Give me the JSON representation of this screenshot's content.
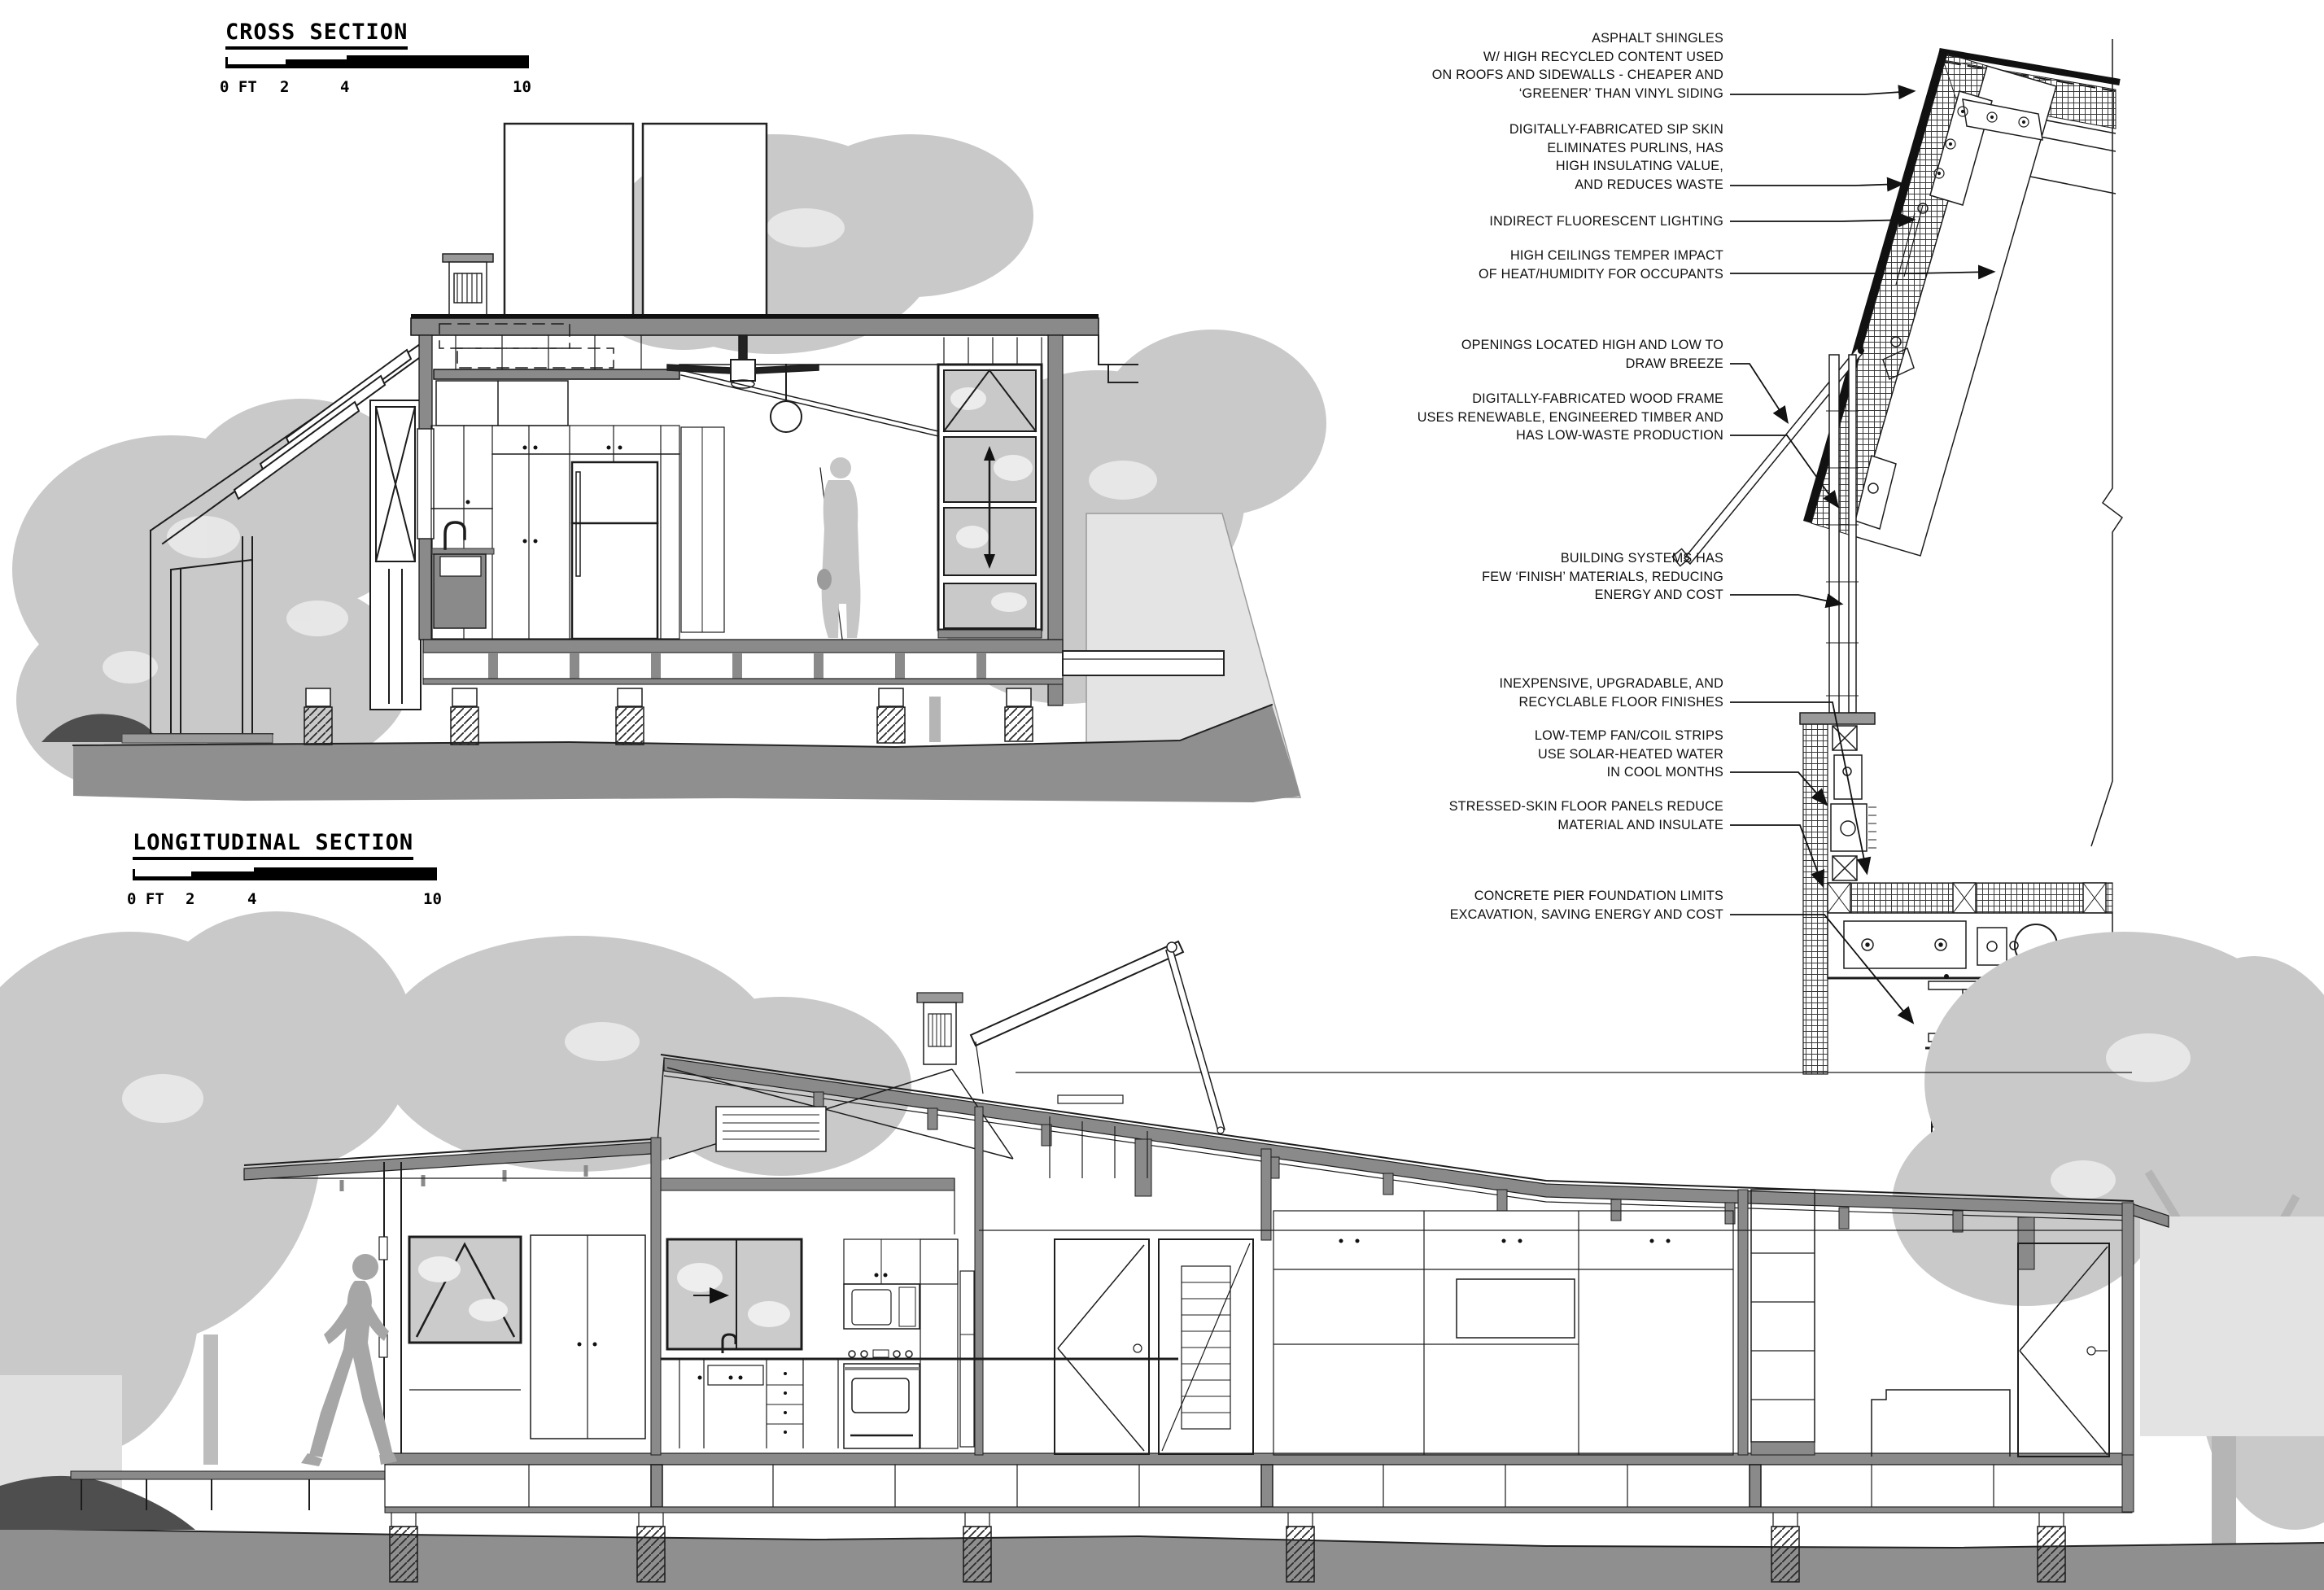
{
  "cross_section": {
    "title": "CROSS SECTION",
    "scale": {
      "l0": "0 FT",
      "l1": "2",
      "l2": "4",
      "l3": "10"
    }
  },
  "longitudinal_section": {
    "title": "LONGITUDINAL SECTION",
    "scale": {
      "l0": "0 FT",
      "l1": "2",
      "l2": "4",
      "l3": "10"
    }
  },
  "annotations": [
    {
      "lines": [
        "ASPHALT SHINGLES",
        "W/ HIGH RECYCLED CONTENT USED",
        "ON ROOFS AND SIDEWALLS - CHEAPER AND",
        "‘GREENER’ THAN VINYL SIDING"
      ]
    },
    {
      "lines": [
        "DIGITALLY-FABRICATED SIP SKIN",
        "ELIMINATES PURLINS, HAS",
        "HIGH INSULATING VALUE,",
        "AND REDUCES WASTE"
      ]
    },
    {
      "lines": [
        "INDIRECT FLUORESCENT LIGHTING"
      ]
    },
    {
      "lines": [
        "HIGH CEILINGS TEMPER IMPACT",
        "OF HEAT/HUMIDITY FOR OCCUPANTS"
      ]
    },
    {
      "lines": [
        "OPENINGS LOCATED HIGH AND LOW TO",
        "DRAW BREEZE"
      ]
    },
    {
      "lines": [
        "DIGITALLY-FABRICATED WOOD FRAME",
        "USES RENEWABLE, ENGINEERED TIMBER AND",
        "HAS LOW-WASTE PRODUCTION"
      ]
    },
    {
      "lines": [
        "BUILDING SYSTEMS HAS",
        "FEW ‘FINISH’ MATERIALS, REDUCING",
        "ENERGY AND COST"
      ]
    },
    {
      "lines": [
        "INEXPENSIVE, UPGRADABLE, AND",
        "RECYCLABLE FLOOR FINISHES"
      ]
    },
    {
      "lines": [
        "LOW-TEMP FAN/COIL STRIPS",
        "USE SOLAR-HEATED WATER",
        "IN COOL MONTHS"
      ]
    },
    {
      "lines": [
        "STRESSED-SKIN FLOOR PANELS REDUCE",
        "MATERIAL AND INSULATE"
      ]
    },
    {
      "lines": [
        "CONCRETE PIER FOUNDATION LIMITS",
        "EXCAVATION, SAVING ENERGY AND COST"
      ]
    }
  ],
  "colors": {
    "poche": "#8a8a8a",
    "ground": "#8f8f8f",
    "ground_dark": "#4e4e4e",
    "tree": "#c9c9c9",
    "glass": "#cbcbcb",
    "hill_light": "#e4e4e4",
    "line": "#1c1c1c"
  }
}
